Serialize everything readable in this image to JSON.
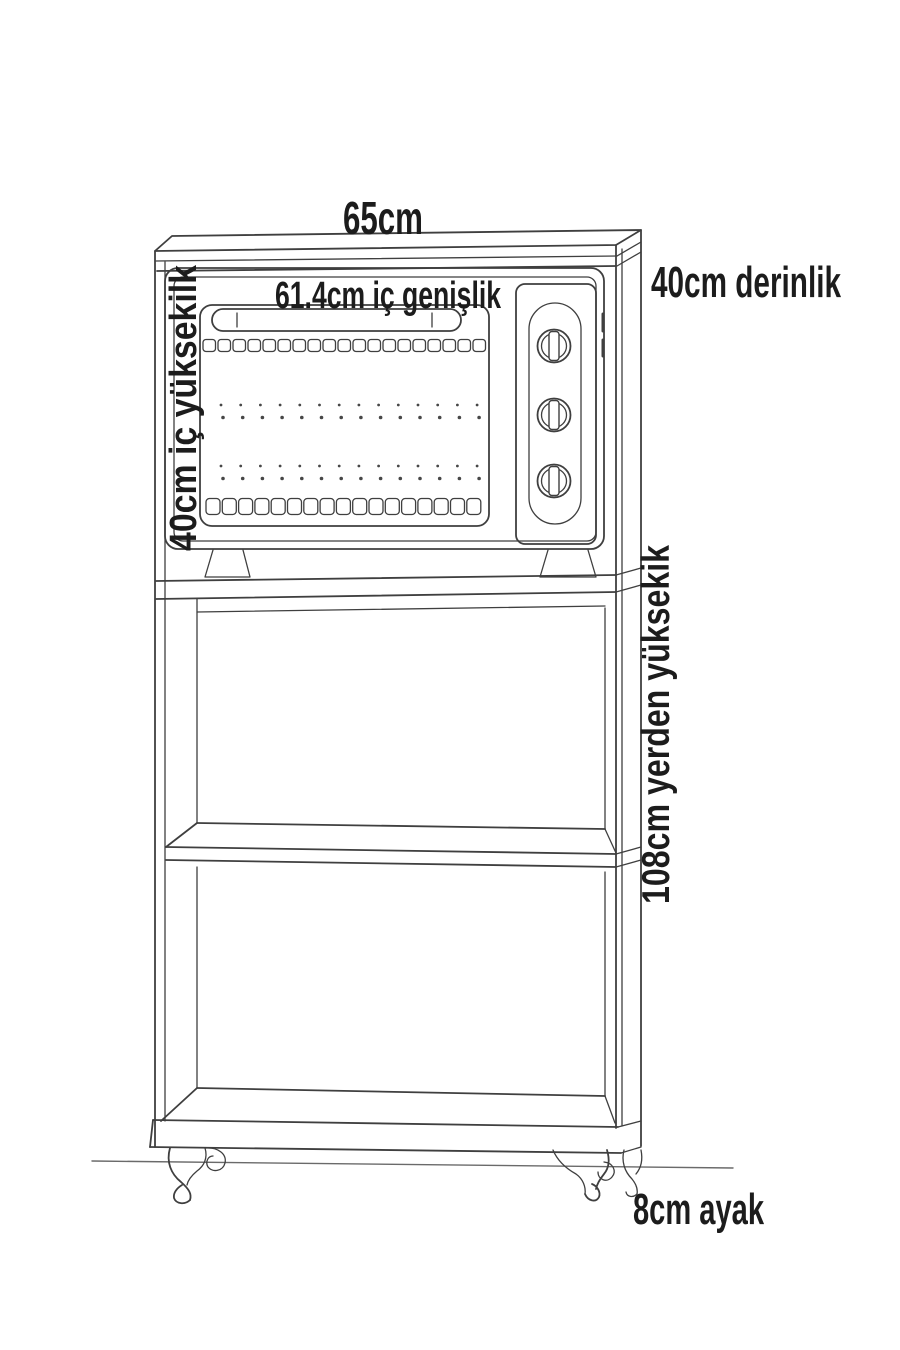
{
  "diagram": {
    "labels": {
      "top_width": "65cm",
      "inner_width": "61.4cm iç genişlik",
      "inner_height": "40cm iç yüksekilk",
      "depth": "40cm derinlik",
      "height_from_floor": "108cm yerden yüksekik",
      "leg_height": "8cm ayak"
    },
    "colors": {
      "line": "#3f3f3f",
      "text": "#1c1c1c",
      "background": "#ffffff"
    }
  }
}
